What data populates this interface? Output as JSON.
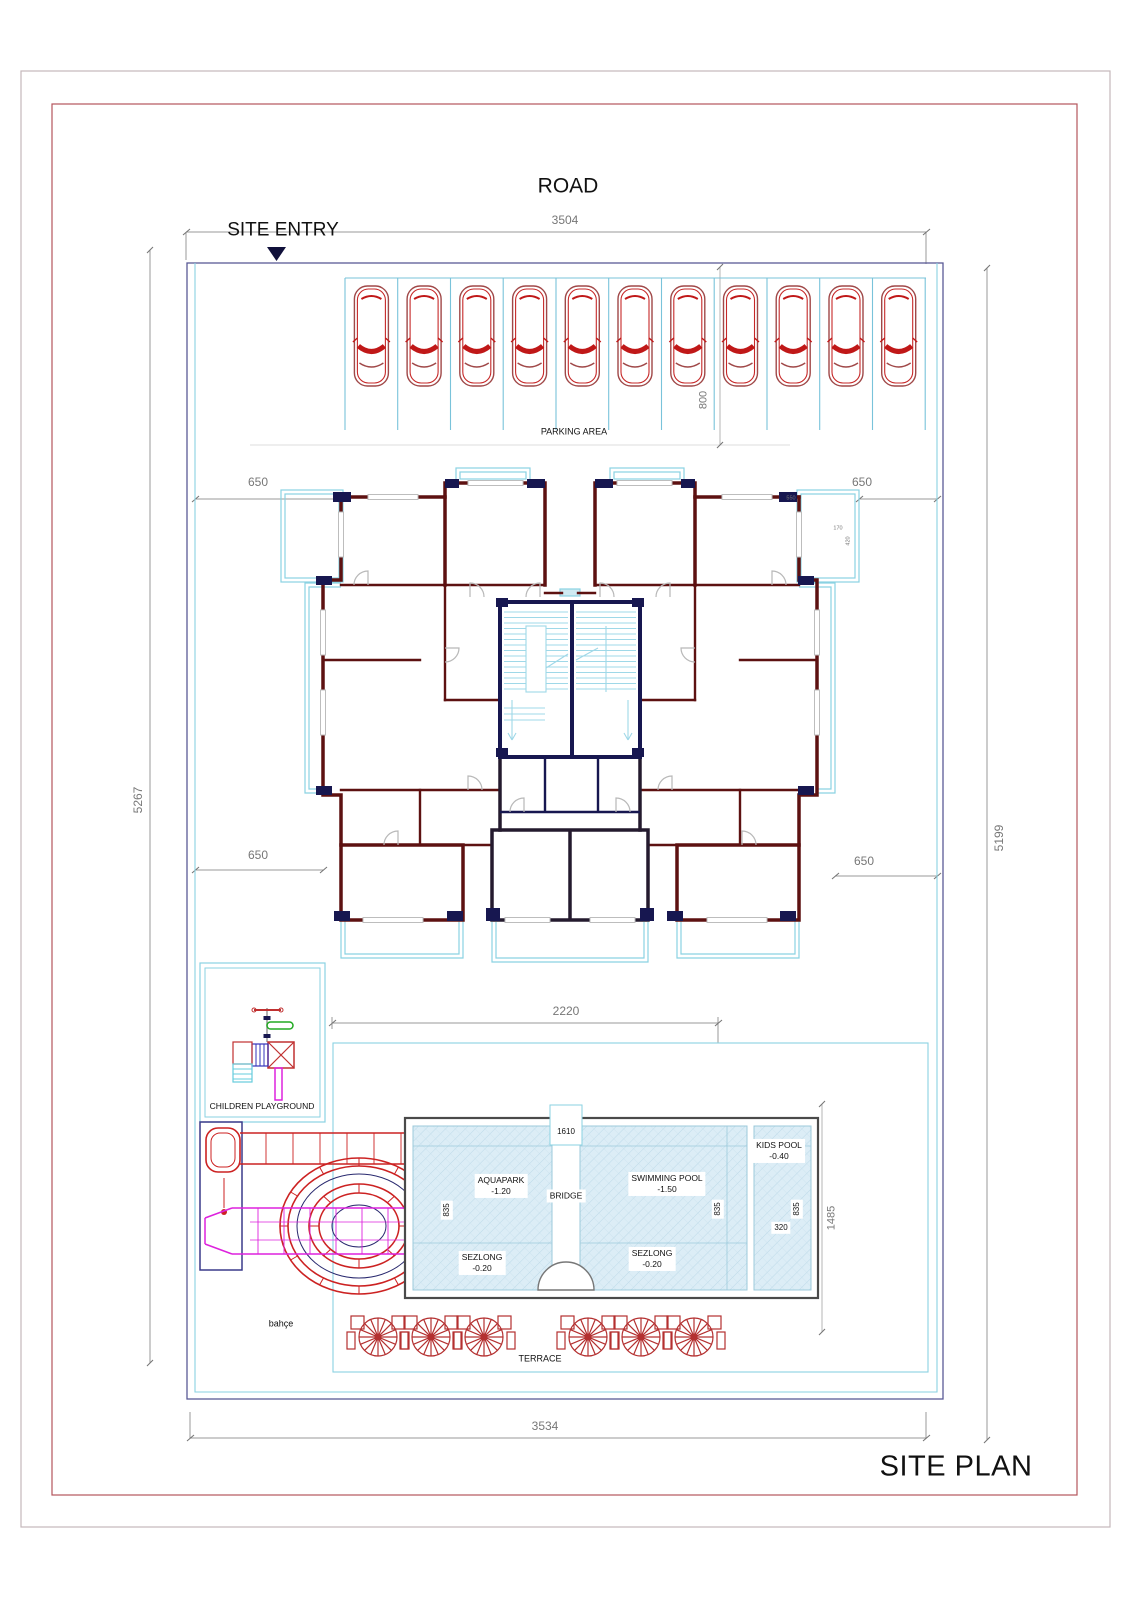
{
  "labels": {
    "road": "ROAD",
    "site_entry": "SITE ENTRY",
    "parking_area": "PARKING AREA",
    "children_playground": "CHILDREN PLAYGROUND",
    "bahce": "bahçe",
    "terrace": "TERRACE",
    "site_plan": "SITE PLAN"
  },
  "pool": {
    "aquapark": {
      "name": "AQUAPARK",
      "level": "-1.20"
    },
    "bridge": {
      "name": "BRIDGE"
    },
    "swimming_pool": {
      "name": "SWIMMING POOL",
      "level": "-1.50"
    },
    "kids_pool": {
      "name": "KIDS POOL",
      "level": "-0.40"
    },
    "sezlong_left": {
      "name": "SEZLONG",
      "level": "-0.20"
    },
    "sezlong_right": {
      "name": "SEZLONG",
      "level": "-0.20"
    }
  },
  "dimensions": {
    "road_width": "3504",
    "bottom_width": "3534",
    "left_height": "5267",
    "right_height": "5199",
    "parking_depth": "800",
    "setback_top_left": "650",
    "setback_top_right": "650",
    "setback_bottom_left": "650",
    "setback_bottom_right": "650",
    "building_width": "2220",
    "bridge_top": "1610",
    "basin_left": "835",
    "basin_right": "835",
    "kids_basin": "835",
    "kids_width": "320",
    "pool_length": "1485",
    "balcony_width": "550",
    "balcony_d1": "170",
    "balcony_d2": "420"
  },
  "counts": {
    "cars": 11,
    "terrace_tables": 6
  },
  "colors": {
    "wall_maroon": "#5D1111",
    "accent_navy": "#171750",
    "balcony_cyan": "#8AD2E2",
    "pool_fill": "#DCEDF6",
    "car_red": "#C62828",
    "slide_magenta": "#DD22DD",
    "frame_red": "#B4555C",
    "boundary_navy": "#5A5A96"
  }
}
